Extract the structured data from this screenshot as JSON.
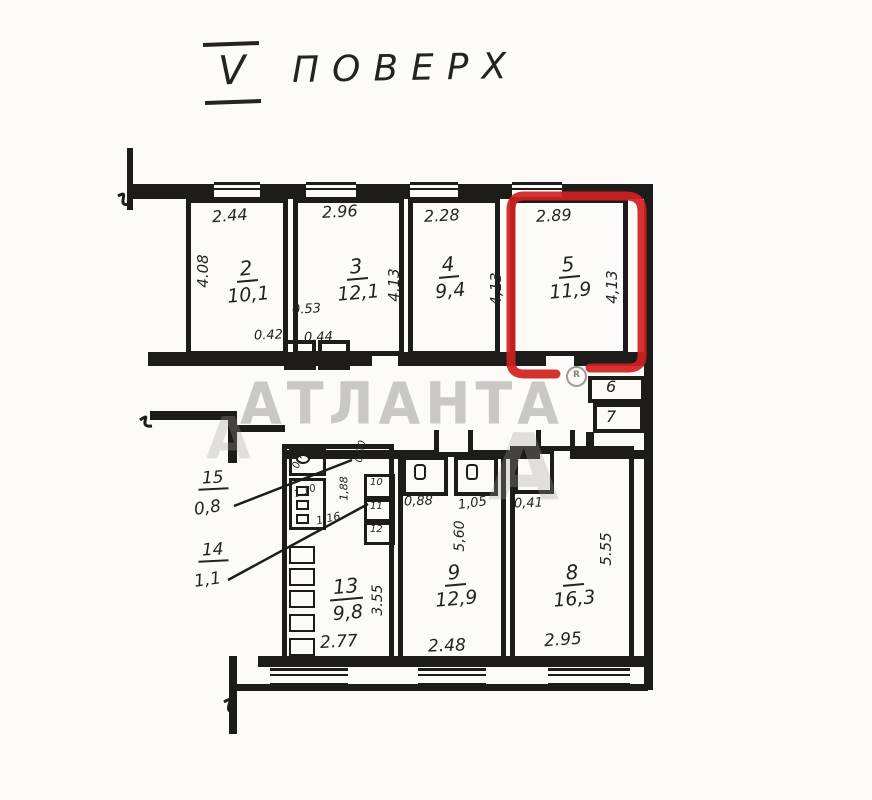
{
  "title": {
    "floor_numeral": "V",
    "floor_word": "ПОВЕРХ"
  },
  "watermark": {
    "text": "АТЛАНТА",
    "reg": "R",
    "ghost_letter": "А"
  },
  "colors": {
    "ink": "#1d1c1a",
    "paper": "#fcfbf8",
    "highlight_red": "#d02020",
    "watermark_gray": "#969696"
  },
  "rooms": {
    "room2": {
      "number": "2",
      "area": "10,1",
      "width": "2.44",
      "height": "4.08"
    },
    "room3": {
      "number": "3",
      "area": "12,1",
      "width": "2.96",
      "height": "4,13"
    },
    "room4": {
      "number": "4",
      "area": "9,4",
      "width": "2.28",
      "height": "4,13"
    },
    "room5": {
      "number": "5",
      "area": "11,9",
      "width": "2.89",
      "height": "4,13",
      "highlighted": true
    },
    "room6": {
      "number": "6"
    },
    "room7": {
      "number": "7"
    },
    "room8": {
      "number": "8",
      "area": "16,3",
      "width": "2.95",
      "height": "5.55",
      "niche_dim": "0,41"
    },
    "room9": {
      "number": "9",
      "area": "12,9",
      "width": "2.48",
      "height": "5,60",
      "wc_left_dim": "0,88",
      "wc_right_dim": "1,05"
    },
    "room10": {
      "number": "10"
    },
    "room11": {
      "number": "11"
    },
    "room12": {
      "number": "12"
    },
    "room13": {
      "number": "13",
      "area": "9,8",
      "width": "2.77",
      "height": "3.55"
    },
    "room14": {
      "number": "14",
      "area": "1,1"
    },
    "room15": {
      "number": "15",
      "area": "0,8"
    }
  },
  "small_dims": {
    "closet_depth": "0.53",
    "closet_left": "0.42",
    "closet_right": "0.44",
    "cluster_height": "1,88",
    "cluster_width": "1,16",
    "cluster_door": "1,10",
    "cluster_small": "0,76",
    "cluster_top": "0,90"
  }
}
